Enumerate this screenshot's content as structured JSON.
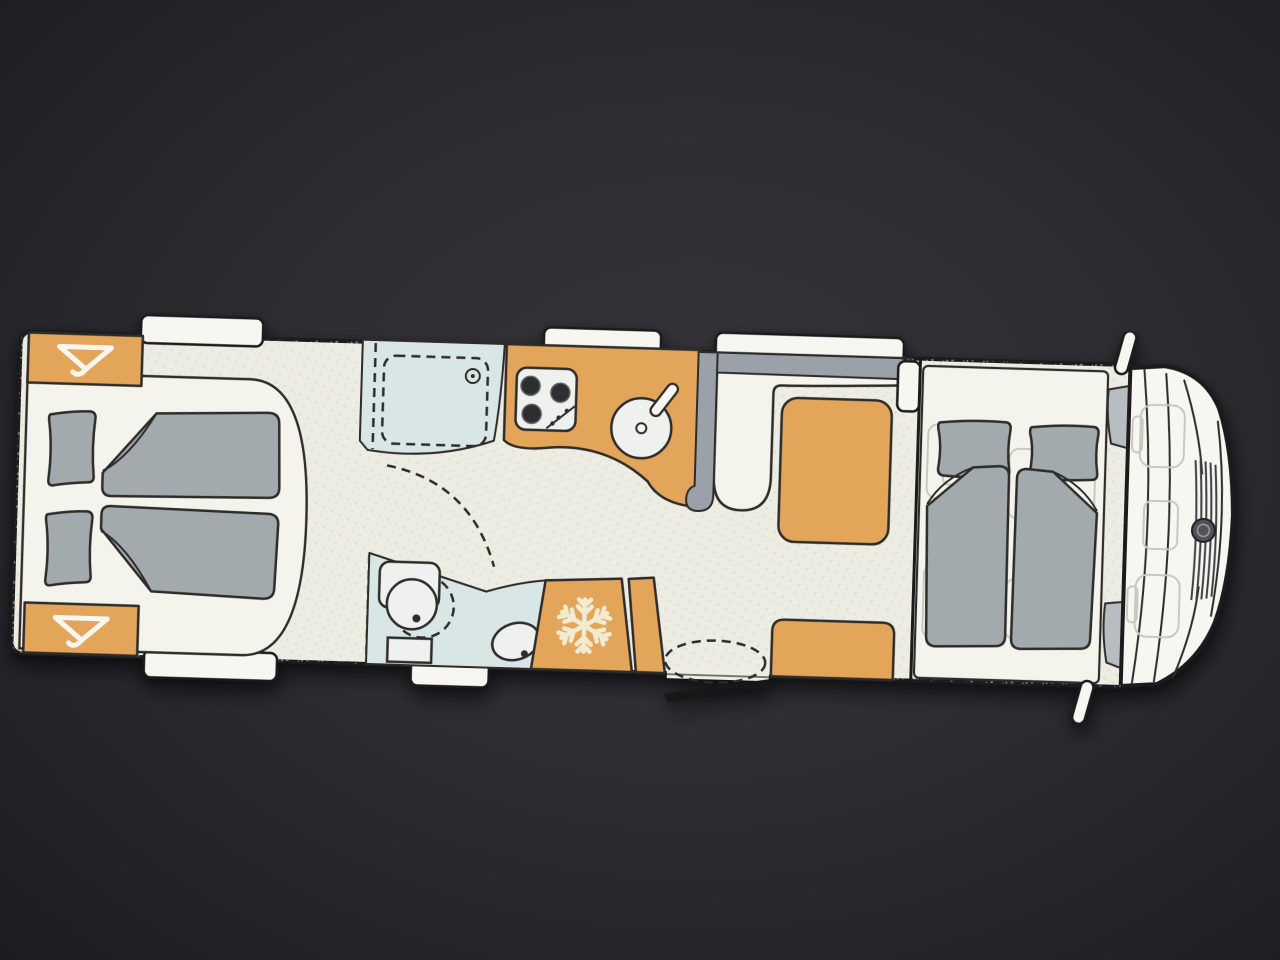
{
  "scene": {
    "type": "motorhome floor plan, top-down view",
    "cab_position": "right",
    "background": "dark charcoal photographed screen"
  },
  "colors": {
    "bg1": "#36353a",
    "bg2": "#1d1c21",
    "cream": "#eeede4",
    "cream2": "#f4f3ec",
    "white": "#f7f6f0",
    "orange": "#e2a55a",
    "mattress": "#a3aaad",
    "gray": "#9aa1a9",
    "blue": "#d9e6e6",
    "fixture": "#eef1ee",
    "glass": "#b7bdc1",
    "ghost": "#c9c9c2",
    "snow": "#f2ebd2",
    "dark": "#2e2e32",
    "outline": "#1b1b1e",
    "outline2": "#2e2c2a",
    "logo": "#52525a",
    "door": "#17171a"
  },
  "floorplan": {
    "zones": [
      {
        "id": "rear-twin-bedroom",
        "beds": 2
      },
      {
        "id": "wardrobes",
        "count": 2,
        "icon": "hanger-icon"
      },
      {
        "id": "shower-room",
        "icon": "shower-head-icon"
      },
      {
        "id": "wc-room",
        "fixtures": [
          "toilet",
          "washbasin"
        ]
      },
      {
        "id": "kitchen",
        "hob_burners": 3,
        "sink": 1
      },
      {
        "id": "fridge",
        "icon": "snowflake-icon"
      },
      {
        "id": "entry-door",
        "state": "open"
      },
      {
        "id": "lounge-dinette",
        "table": 1,
        "benches": 2
      },
      {
        "id": "drop-down-bed",
        "beds": 2
      },
      {
        "id": "driver-cab",
        "seats": 2,
        "icon": "brand-logo-icon"
      }
    ],
    "windows": {
      "top": 3,
      "bottom": 2
    },
    "side_mirrors": 2
  }
}
